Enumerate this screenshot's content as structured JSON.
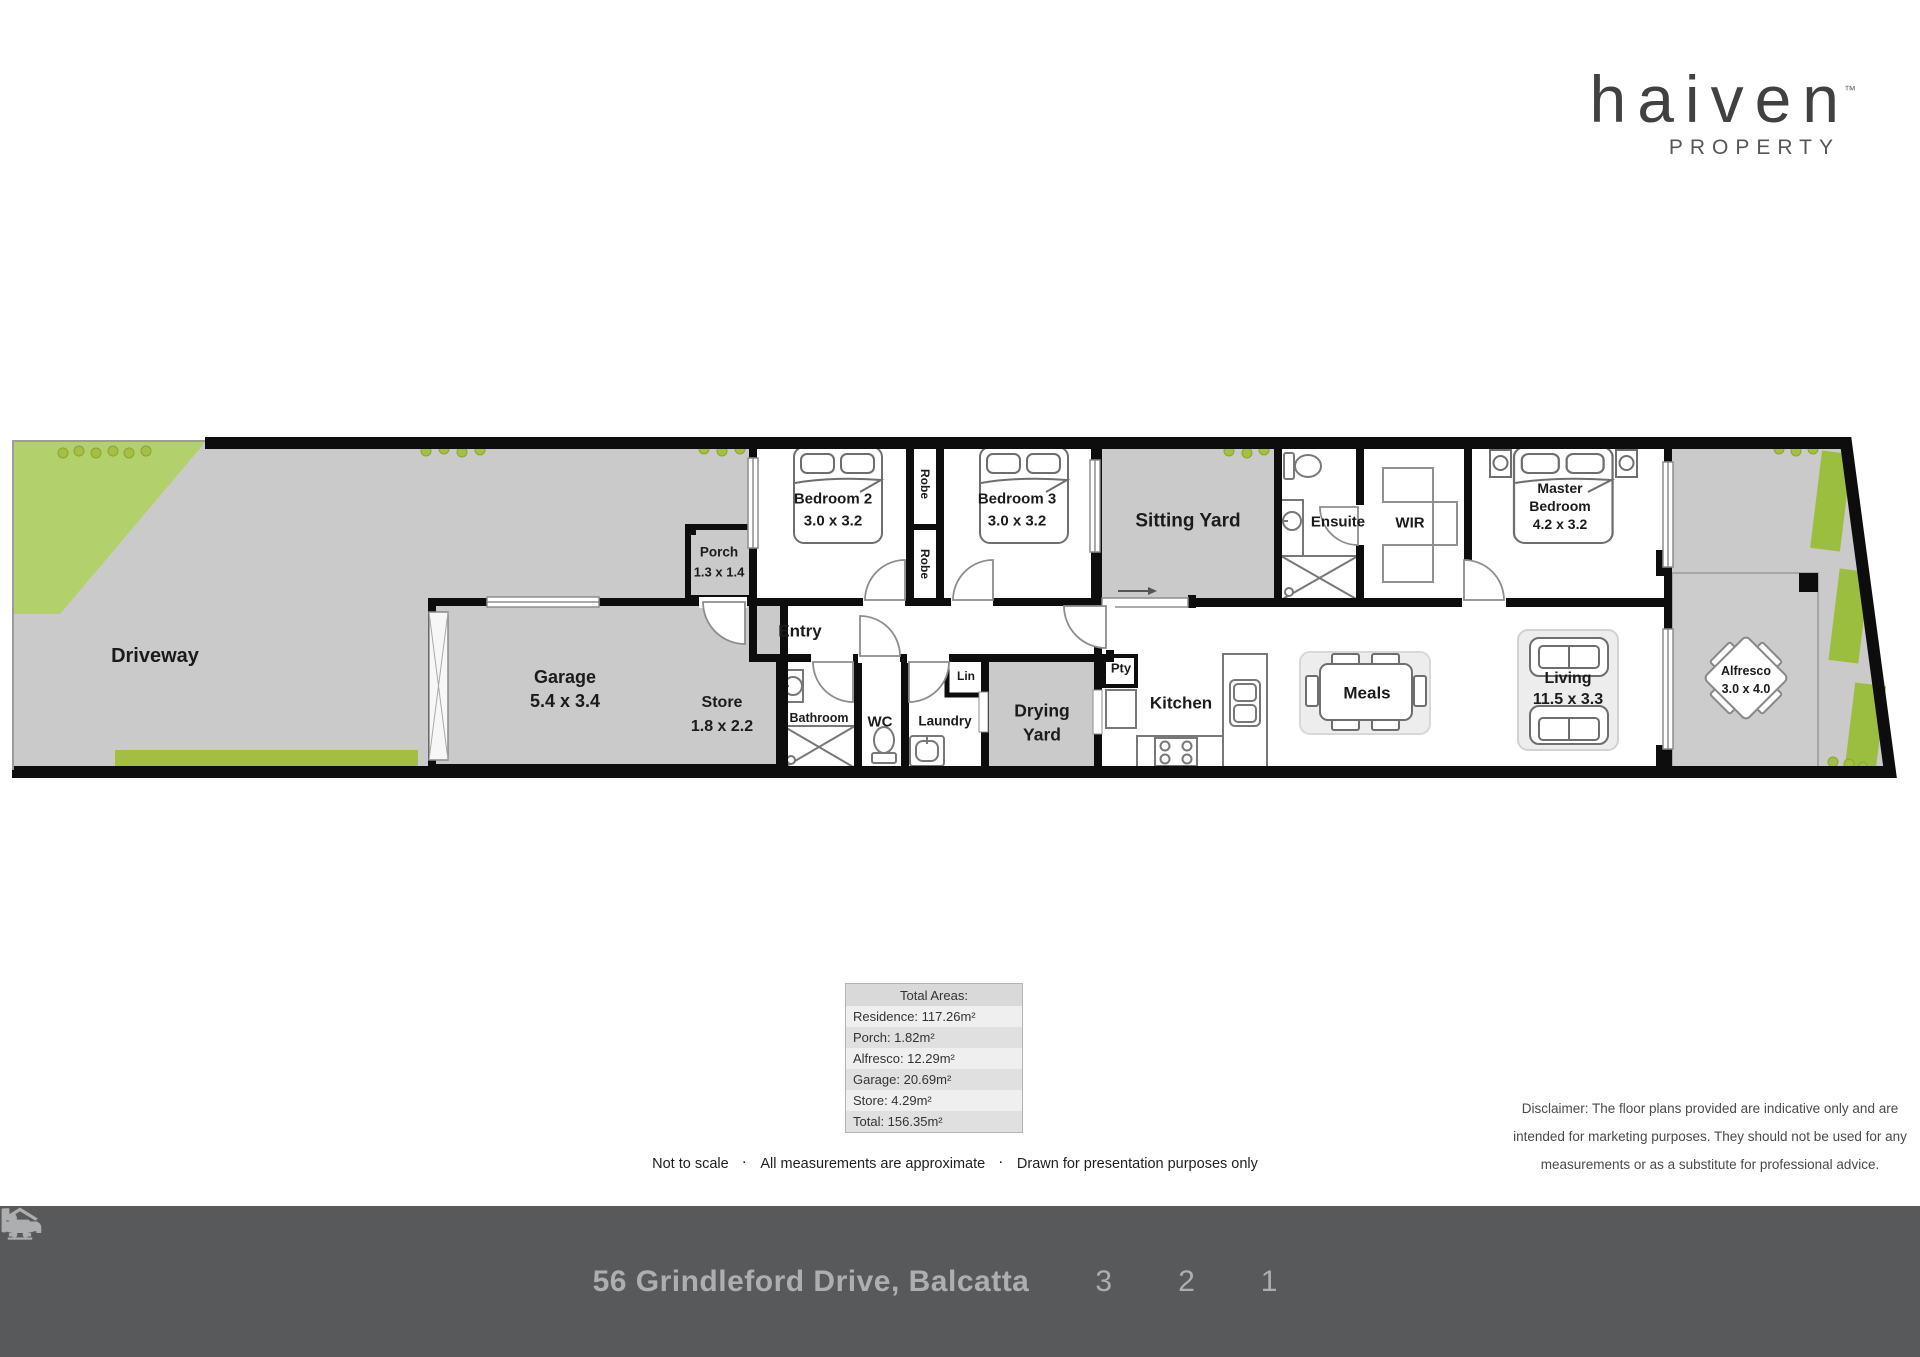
{
  "logo": {
    "brand": "haiven",
    "tm": "™",
    "tagline": "PROPERTY"
  },
  "plan": {
    "driveway": "Driveway",
    "garage_name": "Garage",
    "garage_dim": "5.4 x 3.4",
    "store_name": "Store",
    "store_dim": "1.8 x 2.2",
    "porch_name": "Porch",
    "porch_dim": "1.3 x 1.4",
    "entry": "Entry",
    "bedroom2_name": "Bedroom 2",
    "bedroom2_dim": "3.0 x 3.2",
    "robe_top": "Robe",
    "robe_bottom": "Robe",
    "bedroom3_name": "Bedroom 3",
    "bedroom3_dim": "3.0 x 3.2",
    "sitting_yard": "Sitting Yard",
    "ensuite": "Ensuite",
    "wir": "WIR",
    "master_line1": "Master",
    "master_line2": "Bedroom",
    "master_dim": "4.2 x 3.2",
    "bathroom": "Bathroom",
    "wc": "WC",
    "laundry": "Laundry",
    "lin": "Lin",
    "drying_line1": "Drying",
    "drying_line2": "Yard",
    "pty": "Pty",
    "kitchen": "Kitchen",
    "meals": "Meals",
    "living_name": "Living",
    "living_dim": "11.5 x 3.3",
    "alfresco_name": "Alfresco",
    "alfresco_dim": "3.0 x 4.0"
  },
  "areas": {
    "title": "Total Areas:",
    "rows": [
      "Residence: 117.26m²",
      "Porch: 1.82m²",
      "Alfresco: 12.29m²",
      "Garage: 20.69m²",
      "Store: 4.29m²",
      "Total: 156.35m²"
    ]
  },
  "notes": {
    "sep": "·",
    "items": [
      "Not to scale",
      "All measurements are approximate",
      "Drawn for presentation purposes only"
    ]
  },
  "disclaimer": {
    "line1": "Disclaimer: The floor plans provided are indicative only and are",
    "line2": "intended for marketing purposes. They should not be used for any",
    "line3": "measurements or as a substitute for professional advice."
  },
  "footer": {
    "address": "56 Grindleford Drive, Balcatta",
    "beds": "3",
    "baths": "2",
    "cars": "1"
  }
}
